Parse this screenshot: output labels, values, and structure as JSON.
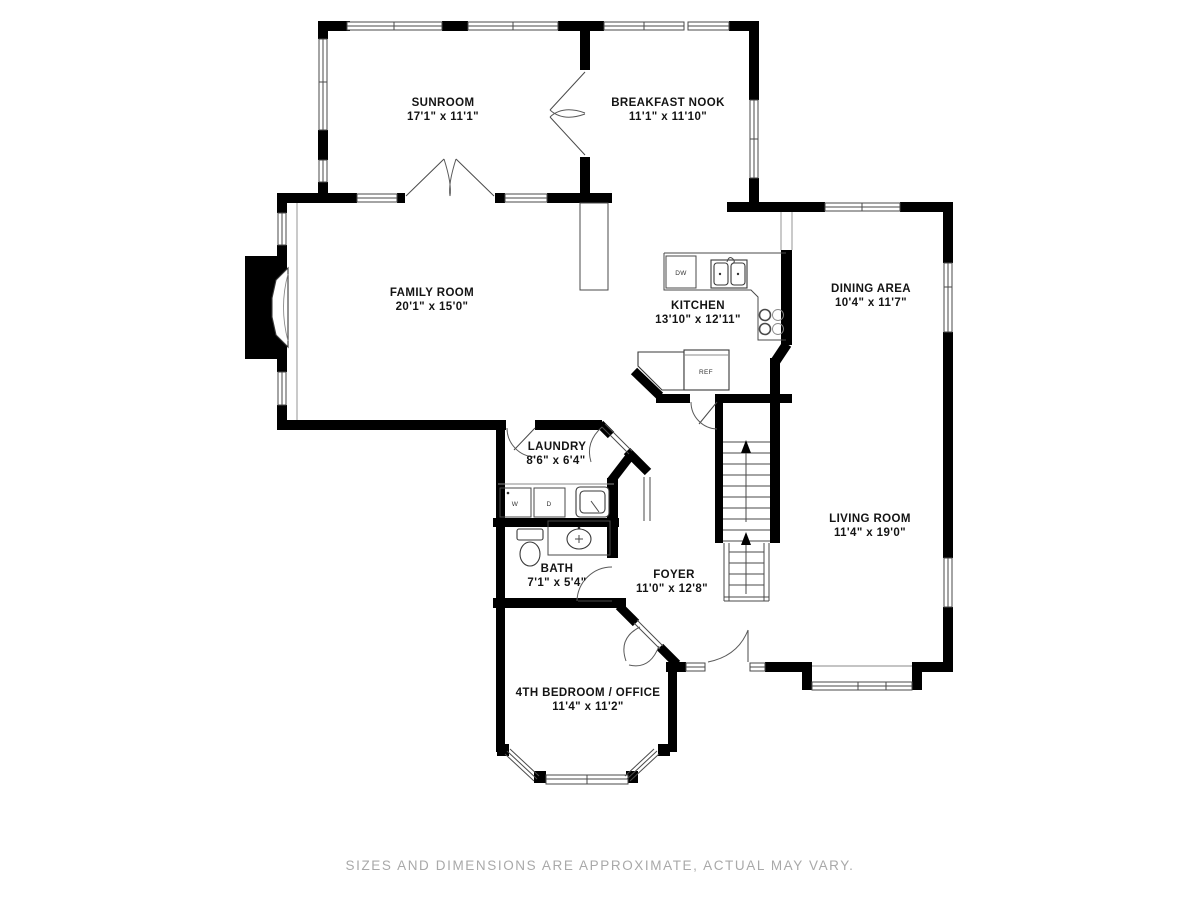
{
  "rooms": [
    {
      "id": "sunroom",
      "name": "SUNROOM",
      "dims": "17'1\" x 11'1\""
    },
    {
      "id": "breakfast-nook",
      "name": "BREAKFAST NOOK",
      "dims": "11'1\" x 11'10\""
    },
    {
      "id": "family-room",
      "name": "FAMILY ROOM",
      "dims": "20'1\" x 15'0\""
    },
    {
      "id": "kitchen",
      "name": "KITCHEN",
      "dims": "13'10\" x 12'11\""
    },
    {
      "id": "dining-area",
      "name": "DINING AREA",
      "dims": "10'4\" x 11'7\""
    },
    {
      "id": "laundry",
      "name": "LAUNDRY",
      "dims": "8'6\" x 6'4\""
    },
    {
      "id": "living-room",
      "name": "LIVING ROOM",
      "dims": "11'4\" x 19'0\""
    },
    {
      "id": "bath",
      "name": "BATH",
      "dims": "7'1\" x 5'4\""
    },
    {
      "id": "foyer",
      "name": "FOYER",
      "dims": "11'0\" x 12'8\""
    },
    {
      "id": "bedroom-office",
      "name": "4TH BEDROOM / OFFICE",
      "dims": "11'4\" x 11'2\""
    }
  ],
  "appliances": {
    "dishwasher": "DW",
    "refrigerator": "REF",
    "washer": "W",
    "dryer": "D"
  },
  "footer": {
    "disclaimer": "SIZES AND DIMENSIONS ARE APPROXIMATE, ACTUAL MAY VARY."
  },
  "colors": {
    "wall": "#000000",
    "thin_line": "#4a4a4a",
    "label_text": "#141414",
    "footer_text": "#a9a9a9",
    "background": "#ffffff"
  }
}
